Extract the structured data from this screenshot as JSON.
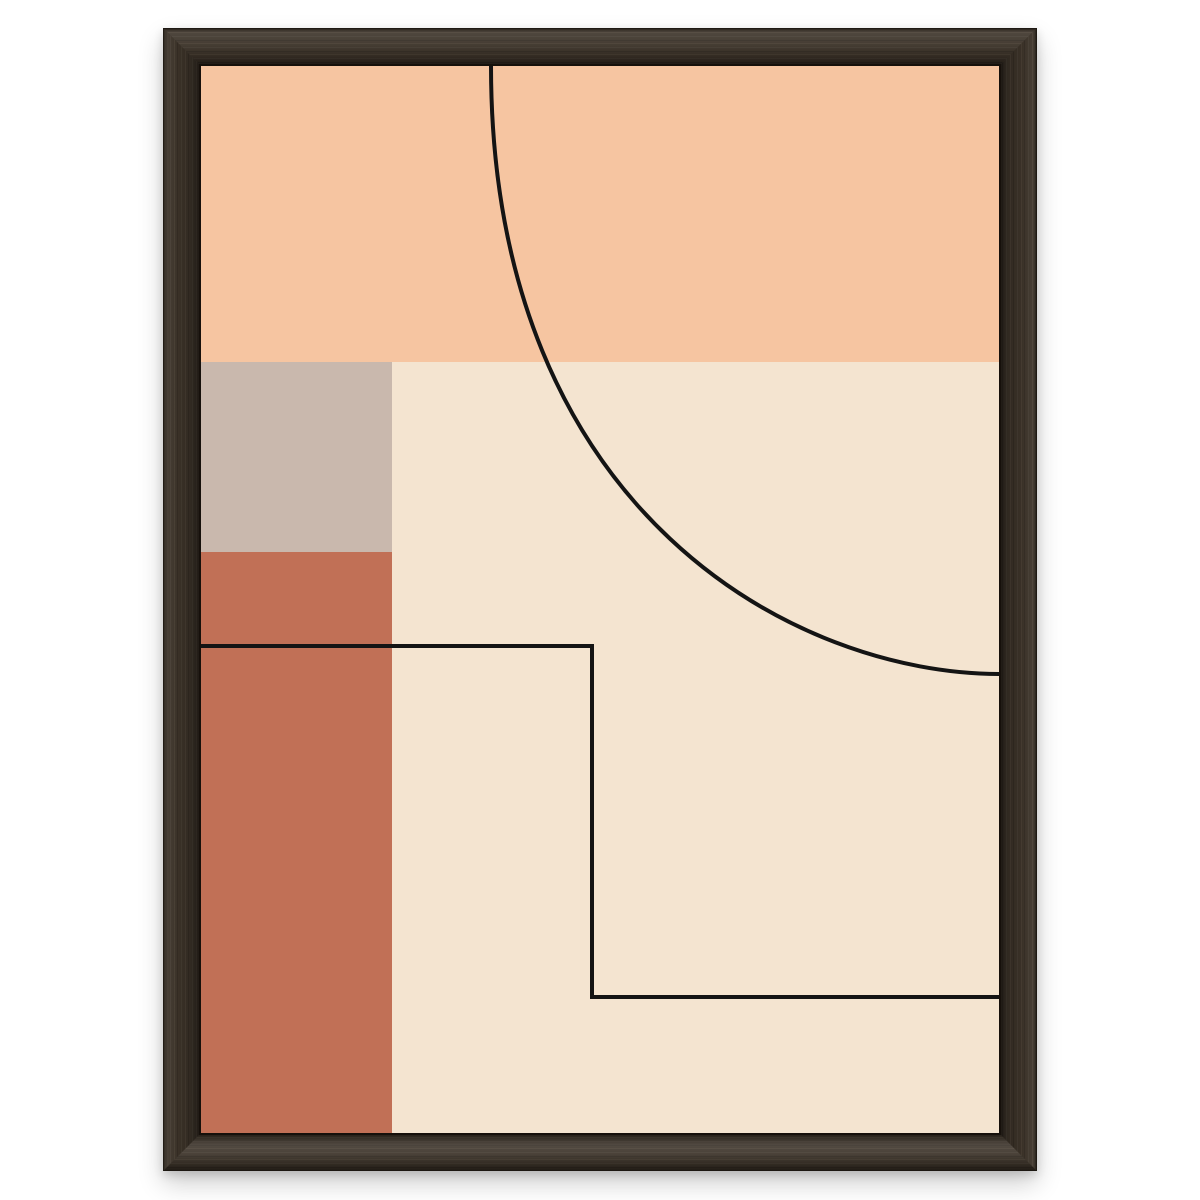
{
  "scene": {
    "kind": "framed-art-print-mockup",
    "background_color": "#ffffff",
    "artwork_style": "minimalist geometric abstract, mid-century palette",
    "text_content": "none"
  },
  "frame": {
    "material": "dark walnut wood, mitered corners",
    "base_color": "#3b3228",
    "grain_light": "#5a4c3d",
    "grain_dark": "#261f18",
    "inner_lip_color": "#16100b"
  },
  "artwork": {
    "viewbox": "0 0 798 1067",
    "palette": {
      "peach": "#f6c5a1",
      "cream": "#f4e4d0",
      "greige": "#c9b8ad",
      "terracotta": "#c17056",
      "line": "#141414"
    },
    "shapes": [
      {
        "name": "cream-field",
        "kind": "rect",
        "x": 0,
        "y": 0,
        "w": 798,
        "h": 1067,
        "fill": "cream"
      },
      {
        "name": "peach-band",
        "kind": "rect",
        "x": 0,
        "y": 0,
        "w": 798,
        "h": 296,
        "fill": "peach"
      },
      {
        "name": "greige-square",
        "kind": "rect",
        "x": 0,
        "y": 296,
        "w": 191,
        "h": 190,
        "fill": "greige"
      },
      {
        "name": "terracotta-column",
        "kind": "rect",
        "x": 0,
        "y": 486,
        "w": 191,
        "h": 581,
        "fill": "terracotta"
      },
      {
        "name": "arc-line",
        "kind": "path",
        "d": "M 290 0 C 290 450 598 608 798 608",
        "stroke": "line",
        "stroke_width": 4
      },
      {
        "name": "step-line",
        "kind": "path",
        "d": "M 0 580 L 391 580 L 391 931 L 798 931",
        "stroke": "line",
        "stroke_width": 4
      }
    ]
  }
}
